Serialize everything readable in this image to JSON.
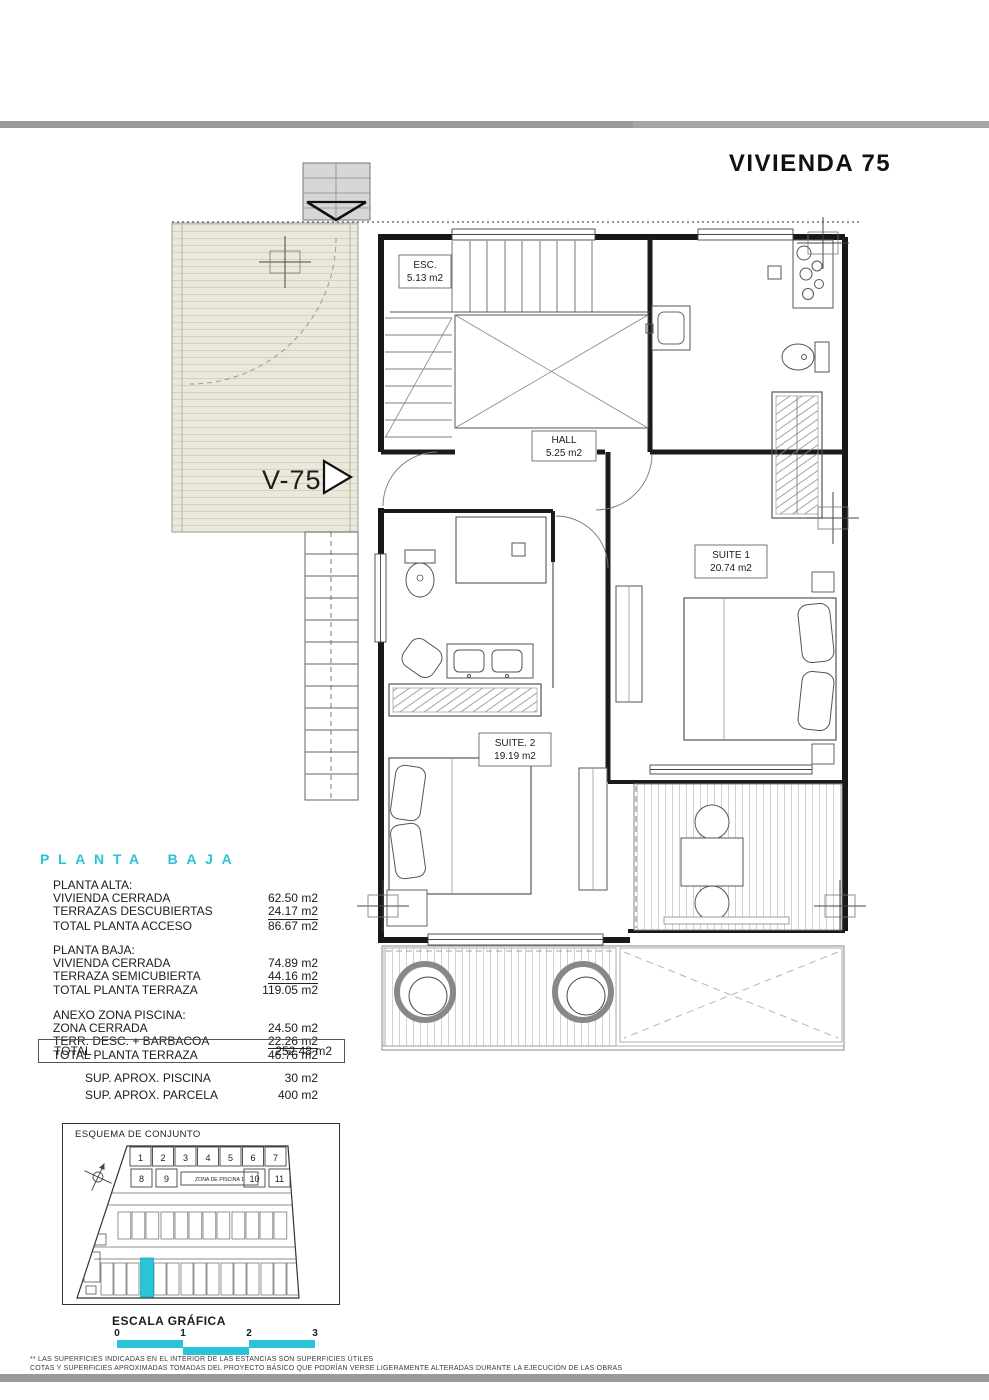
{
  "page": {
    "title": "VIVIENDA 75"
  },
  "plan": {
    "unit_arrow_label": "V-75",
    "rooms": {
      "esc": {
        "name": "ESC.",
        "area": "5.13 m2"
      },
      "hall": {
        "name": "HALL",
        "area": "5.25 m2"
      },
      "suite1": {
        "name": "SUITE 1",
        "area": "20.74 m2"
      },
      "suite2": {
        "name": "SUITE. 2",
        "area": "19.19 m2"
      }
    }
  },
  "section": {
    "title": "PLANTA BAJA"
  },
  "areas_table": {
    "groups": [
      {
        "header": "PLANTA ALTA:",
        "rows": [
          {
            "label": "VIVIENDA CERRADA",
            "value": "62.50 m2"
          },
          {
            "label": "TERRAZAS DESCUBIERTAS",
            "value": "24.17 m2"
          },
          {
            "label": "TOTAL PLANTA ACCESO",
            "value": "86.67 m2"
          }
        ]
      },
      {
        "header": "PLANTA BAJA:",
        "rows": [
          {
            "label": "VIVIENDA CERRADA",
            "value": "74.89 m2"
          },
          {
            "label": "TERRAZA SEMICUBIERTA",
            "value": "44.16 m2"
          },
          {
            "label": "TOTAL PLANTA TERRAZA",
            "value": "119.05 m2"
          }
        ]
      },
      {
        "header": "ANEXO ZONA PISCINA:",
        "rows": [
          {
            "label": "ZONA CERRADA",
            "value": "24.50 m2"
          },
          {
            "label": "TERR. DESC. + BARBACOA",
            "value": "22.26 m2"
          },
          {
            "label": "TOTAL PLANTA TERRAZA",
            "value": "46.76 m2"
          }
        ]
      }
    ],
    "total": {
      "label": "TOTAL",
      "value": "252.48 m2"
    },
    "extras": [
      {
        "label": "SUP.  APROX. PISCINA",
        "value": "30 m2"
      },
      {
        "label": "SUP.  APROX. PARCELA",
        "value": "400 m2"
      }
    ]
  },
  "site_plan": {
    "title": "ESQUEMA DE CONJUNTO",
    "row1_units": [
      "1",
      "2",
      "3",
      "4",
      "5",
      "6",
      "7"
    ],
    "row2_units": [
      "8",
      "9",
      "10",
      "11"
    ],
    "pool_label": "ZONA DE PISCINA 1"
  },
  "scale_bar": {
    "title": "ESCALA GRÁFICA",
    "ticks": [
      "0",
      "1",
      "2",
      "3"
    ]
  },
  "footer": {
    "line1": "** LAS SUPERFICIES INDICADAS EN EL INTERIOR DE LAS ESTANCIAS SON SUPERFICIES ÚTILES",
    "line2": "COTAS Y SUPERFICIES APROXIMADAS TOMADAS DEL PROYECTO BÁSICO QUE PODRÍAN VERSE LIGERAMENTE ALTERADAS DURANTE LA EJECUCIÓN DE LAS OBRAS"
  },
  "colors": {
    "accent": "#29c4d8",
    "divider": "#9a9a9a",
    "terrace_fill": "#ebe7da"
  }
}
